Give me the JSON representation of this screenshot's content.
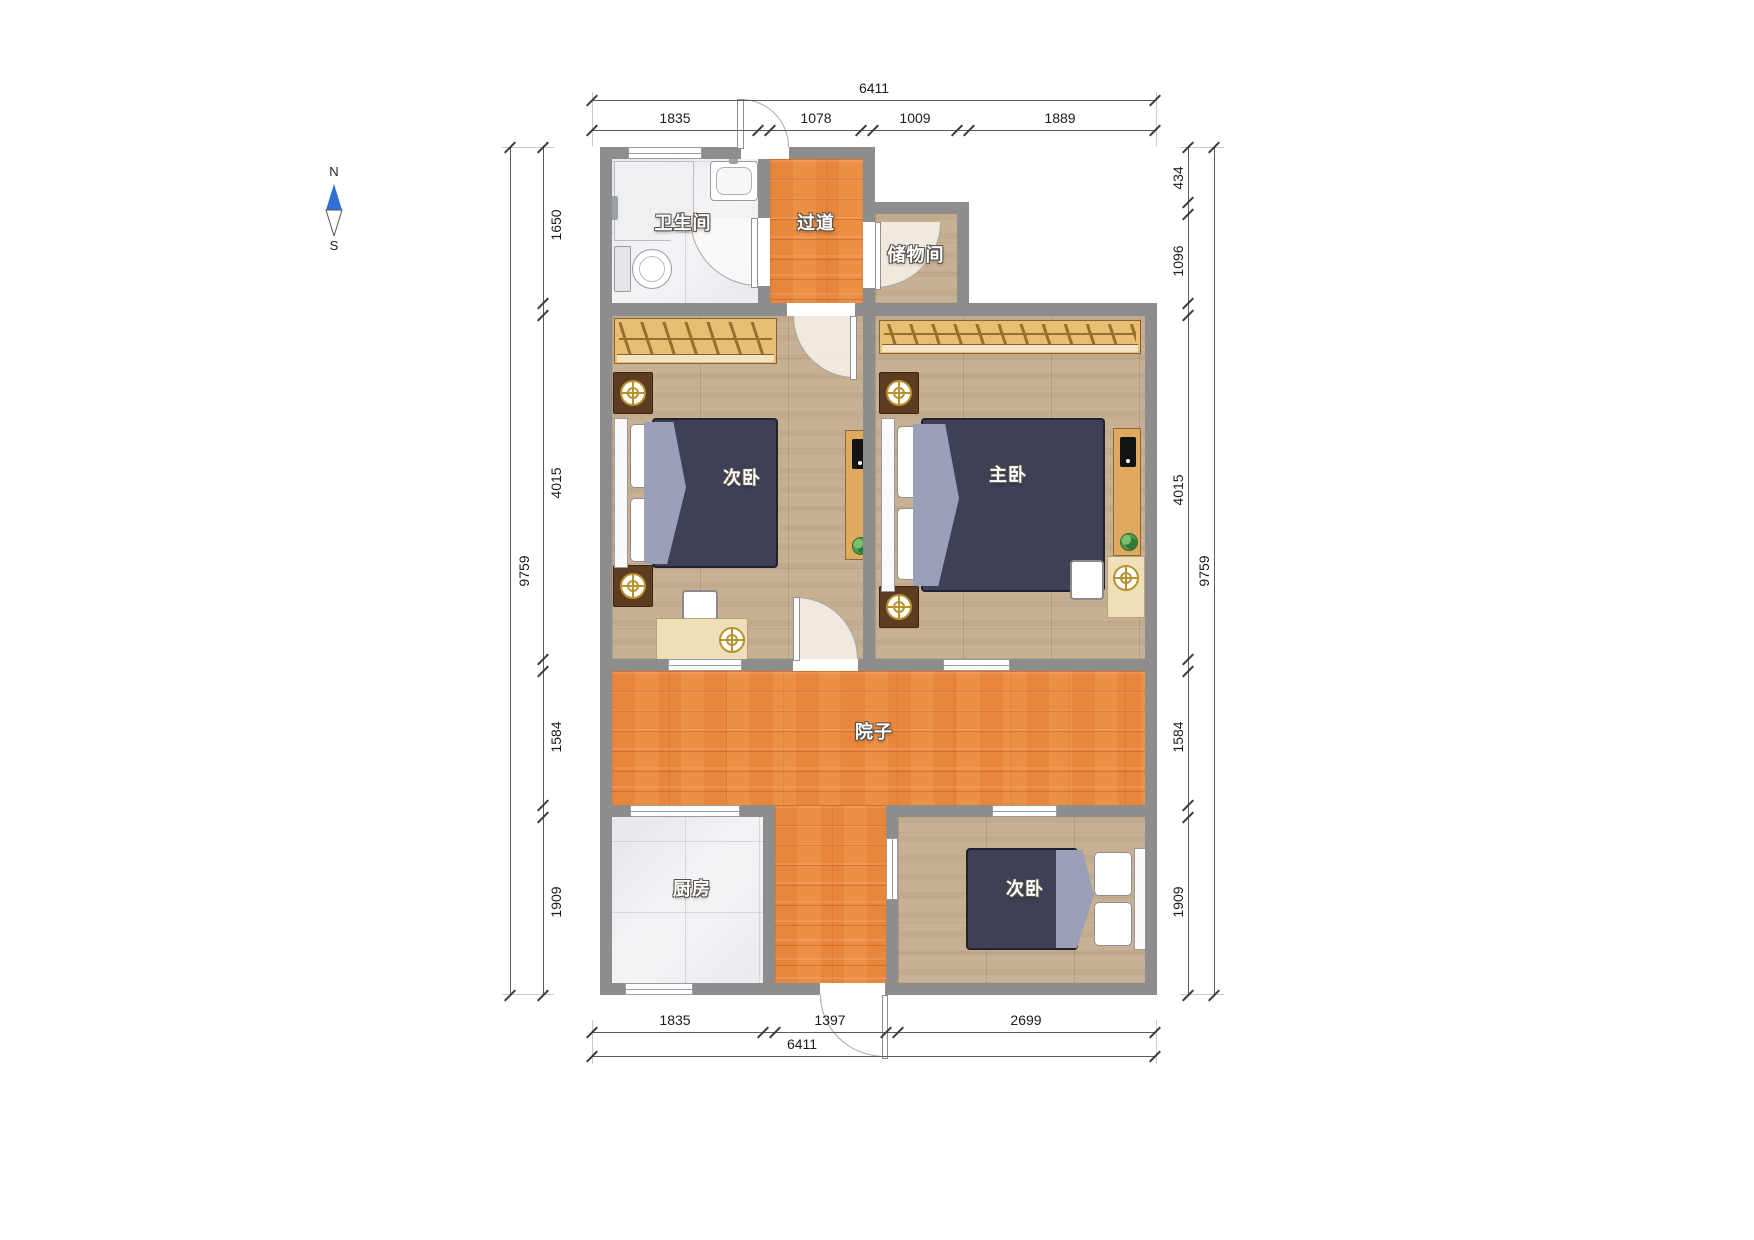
{
  "compass": {
    "north_label": "N",
    "south_label": "S"
  },
  "rooms": {
    "bathroom": {
      "label": "卫生间"
    },
    "hallway": {
      "label": "过道"
    },
    "storage": {
      "label": "储物间"
    },
    "bedroom_north": {
      "label": "次卧"
    },
    "master_bedroom": {
      "label": "主卧"
    },
    "courtyard": {
      "label": "院子"
    },
    "kitchen": {
      "label": "厨房"
    },
    "bedroom_south": {
      "label": "次卧"
    }
  },
  "dimensions": {
    "top": {
      "total": "6411",
      "segments": [
        "1835",
        "1078",
        "1009",
        "1889"
      ]
    },
    "bottom": {
      "total": "6411",
      "segments": [
        "1835",
        "1397",
        "2699"
      ]
    },
    "left": {
      "total": "9759",
      "segments": [
        "1650",
        "4015",
        "1584",
        "1909"
      ]
    },
    "right": {
      "total": "9759",
      "segments": [
        "434",
        "1096",
        "4015",
        "1584",
        "1909"
      ]
    }
  },
  "colors": {
    "wall": "#8d8d8d",
    "wood_floor": "#c8b193",
    "deck_floor": "#e8863b",
    "tile_floor": "#f3f3f6",
    "bed_duvet": "#3e4057",
    "wardrobe": "#e9bd72",
    "lamp_gold": "#b8922e",
    "compass_north": "#2f6fd6"
  }
}
